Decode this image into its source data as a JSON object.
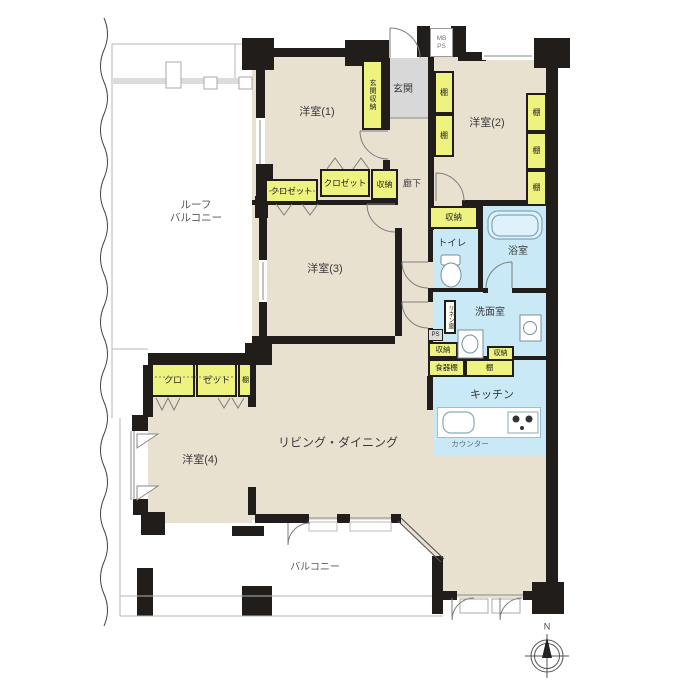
{
  "labels": {
    "roof_balcony_1": "ルーフ",
    "roof_balcony_2": "バルコニー",
    "bedroom1": "洋室(1)",
    "bedroom2": "洋室(2)",
    "bedroom3": "洋室(3)",
    "bedroom4": "洋室(4)",
    "entrance": "玄関",
    "entrance_storage": "玄関収納",
    "mb": "MB",
    "ps_meter": "PS",
    "hallway": "廊下",
    "closet": "クロゼット",
    "closet_a": "クロ",
    "closet_b": "ゼット",
    "storage": "収納",
    "shelf": "棚",
    "toilet": "トイレ",
    "bath": "浴室",
    "washroom": "洗面室",
    "linen": "リネン庫",
    "ps_small": "PS",
    "cupboard": "食器棚",
    "kitchen": "キッチン",
    "counter": "カウンター",
    "living_dining": "リビング・ダイニング",
    "balcony": "バルコニー",
    "north": "N"
  },
  "colors": {
    "wall": "#211d1a",
    "room_floor": "#e9e1d0",
    "wet_area": "#c9e9f6",
    "storage_fill": "#edf37e",
    "entrance_fill": "#d8d8d8"
  }
}
